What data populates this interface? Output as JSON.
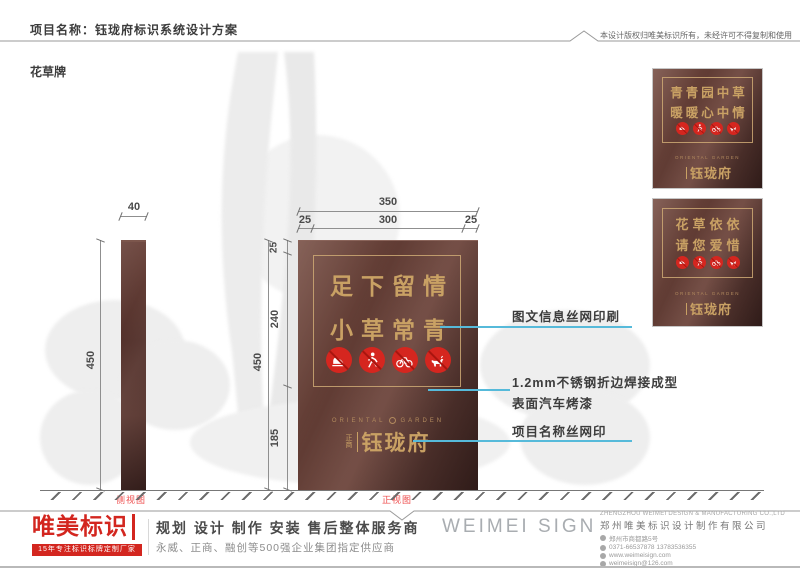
{
  "header": {
    "project_title": "项目名称：钰珑府标识系统设计方案",
    "copyright_note": "本设计版权归唯美标识所有，未经许可不得复制和使用"
  },
  "page_label": "花草牌",
  "side_view": {
    "label": "侧视图",
    "width_dim": "40",
    "height_dim": "450"
  },
  "front_view": {
    "label": "正视图",
    "total_width_dim": "350",
    "left_margin_dim": "25",
    "inner_width_dim": "300",
    "right_margin_dim": "25",
    "total_height_dim": "450",
    "top_margin_dim": "25",
    "upper_height_dim": "240",
    "lower_height_dim": "185"
  },
  "sign": {
    "slogan_line1": "足下留情",
    "slogan_line2": "小草常青",
    "icons": [
      "no-stepping-icon",
      "no-walking-icon",
      "no-bicycle-icon",
      "no-dog-icon"
    ],
    "logo_en_left": "ORIENTAL",
    "logo_en_right": "GARDEN",
    "logo_prefix_top": "正",
    "logo_prefix_bottom": "商",
    "logo_name": "钰珑府"
  },
  "annotations": {
    "print_info": "图文信息丝网印刷",
    "material_line1": "1.2mm不锈钢折边焊接成型",
    "material_line2": "表面汽车烤漆",
    "name_print": "项目名称丝网印"
  },
  "gallery": {
    "panel1": {
      "line1": "青青园中草",
      "line2": "暖暖心中情",
      "logo_en": "ORIENTAL GARDEN",
      "logo_name": "钰珑府"
    },
    "panel2": {
      "line1": "花草依依",
      "line2": "请您爱惜",
      "logo_en": "ORIENTAL GARDEN",
      "logo_name": "钰珑府"
    }
  },
  "footer": {
    "brand_name": "唯美标识",
    "brand_tagline": "15年专注标识标牌定制厂家",
    "services": "规划 设计 制作 安装 售后整体服务商",
    "clients": "永威、正商、融创等500强企业集团指定供应商",
    "wordmark": "WEIMEI SIGN",
    "company_en": "ZHENGZHOU WEIMEI DESIGN & MANUFACTURING CO.,LTD",
    "company_cn": "郑州唯美标识设计制作有限公司",
    "address": "郑州市商都路5号",
    "phone": "0371-66537878  13783536355",
    "website": "www.weimeisign.com",
    "email": "weimeisign@126.com"
  },
  "colors": {
    "sign_brown": "#5f3a32",
    "gold": "#c9a164",
    "prohibition_red": "#d5261f",
    "leader_cyan": "#56bada",
    "brand_red": "#d3261f",
    "view_label_red": "#ee4a4a"
  }
}
